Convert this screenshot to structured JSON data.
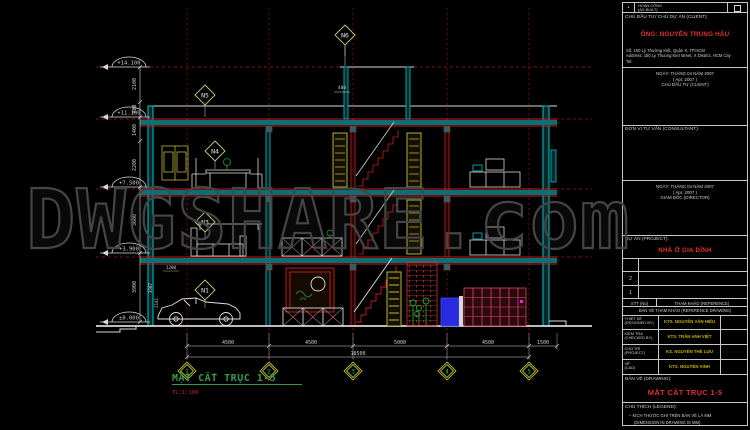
{
  "watermark": {
    "text": "DWGSHARE.com"
  },
  "drawing": {
    "title": "MẶT CẮT TRỤC 1-5",
    "scale": "TL:1:100",
    "elevations": [
      "+14.100",
      "+11.100",
      "+7.500",
      "+3.900",
      "±0.000"
    ],
    "room_tags": [
      "N6",
      "N5",
      "N4",
      "N3",
      "N1"
    ],
    "grid_bubbles": [
      "1",
      "2",
      "3",
      "4",
      "5"
    ],
    "dims_bottom": [
      "4500",
      "4500",
      "5000",
      "4500",
      "1500"
    ],
    "dim_overall": "18500",
    "dims_left": [
      "2100",
      "900",
      "1400",
      "2200",
      "3600",
      "3900"
    ],
    "dim_top": "400",
    "dims_misc": [
      "1200",
      "3507",
      "2141"
    ]
  },
  "titleblock": {
    "asbuilt_dot": "•",
    "asbuilt_label": "HOÀN CÔNG",
    "asbuilt_label_en": "(AS BUILT)",
    "client_header": "CHỦ ĐẦU TƯ/ CHỦ DỰ ÁN (CLIENT):",
    "client_name": "ÔNG: NGUYỄN TRUNG HẬU",
    "client_addr1": "Số: 150 Lý Thường Kiệt, Quận X, TP.HCM",
    "client_addr2": "Address: 150 Ly Thuong Kiet street, X District, HCM City",
    "client_addr3": "Tel:",
    "date1_line1": "NGÀY:  THÁNG 04 NĂM 2007",
    "date1_line2": "(  Apr, 2007 )",
    "date1_line3": "CHỦ ĐẦU TƯ (CLIENT)",
    "consultant_header": "ĐƠN VỊ TƯ VẤN (CONSULTANT):",
    "date2_line1": "NGÀY:  THÁNG 04 NĂM 2007",
    "date2_line2": "(  Apr, 2007 )",
    "date2_line3": "GIÁM ĐỐC (DIRECTOR)",
    "project_label": "DỰ ÁN (PROJECT):",
    "project_name": "NHÀ Ở GIA ĐÌNH",
    "ref_rows": [
      "",
      "2",
      "1"
    ],
    "ref_header_no": "STT (No)",
    "ref_header": "THAM KHẢO (REFERENCE)",
    "ref_caption": "BẢN VẼ THAM KHẢO (REFERENCE DRAWING)",
    "staff": [
      {
        "role": "THIẾT KẾ",
        "role_en": "(DESIGNED BY)",
        "name": "KTS. NGUYỄN VĂN HIẾU"
      },
      {
        "role": "KIỂM TRA",
        "role_en": "(CHECKED BY)",
        "name": "KTS. TRẦN ANH VIỆT"
      },
      {
        "role": "CHỦ TRÌ",
        "role_en": "(PROJECT)",
        "name": "KS. NGUYỄN THẾ LỰU"
      },
      {
        "role": "VẼ",
        "role_en": "(CAD)",
        "name": "KTS. NGUYỄN VINH"
      }
    ],
    "drawing_label": "BẢN VẼ (DRAWING):",
    "drawing_name": "MẶT CẮT TRỤC 1-5",
    "legend_label": "CHÚ THÍCH (LEGEND):",
    "legend_line1": "– KÍCH THƯỚC GHI TRÊN BẢN VẼ LÀ MM",
    "legend_line2": "(DIMENSION IN DRAWING IS MM)"
  },
  "colors": {
    "red": "#cc1d1d",
    "cyan": "#00c8cd",
    "olive": "#b8b83a",
    "green": "#1ea32a",
    "accent_red_text": "#e03030",
    "staff_yellow": "#c8b400"
  }
}
